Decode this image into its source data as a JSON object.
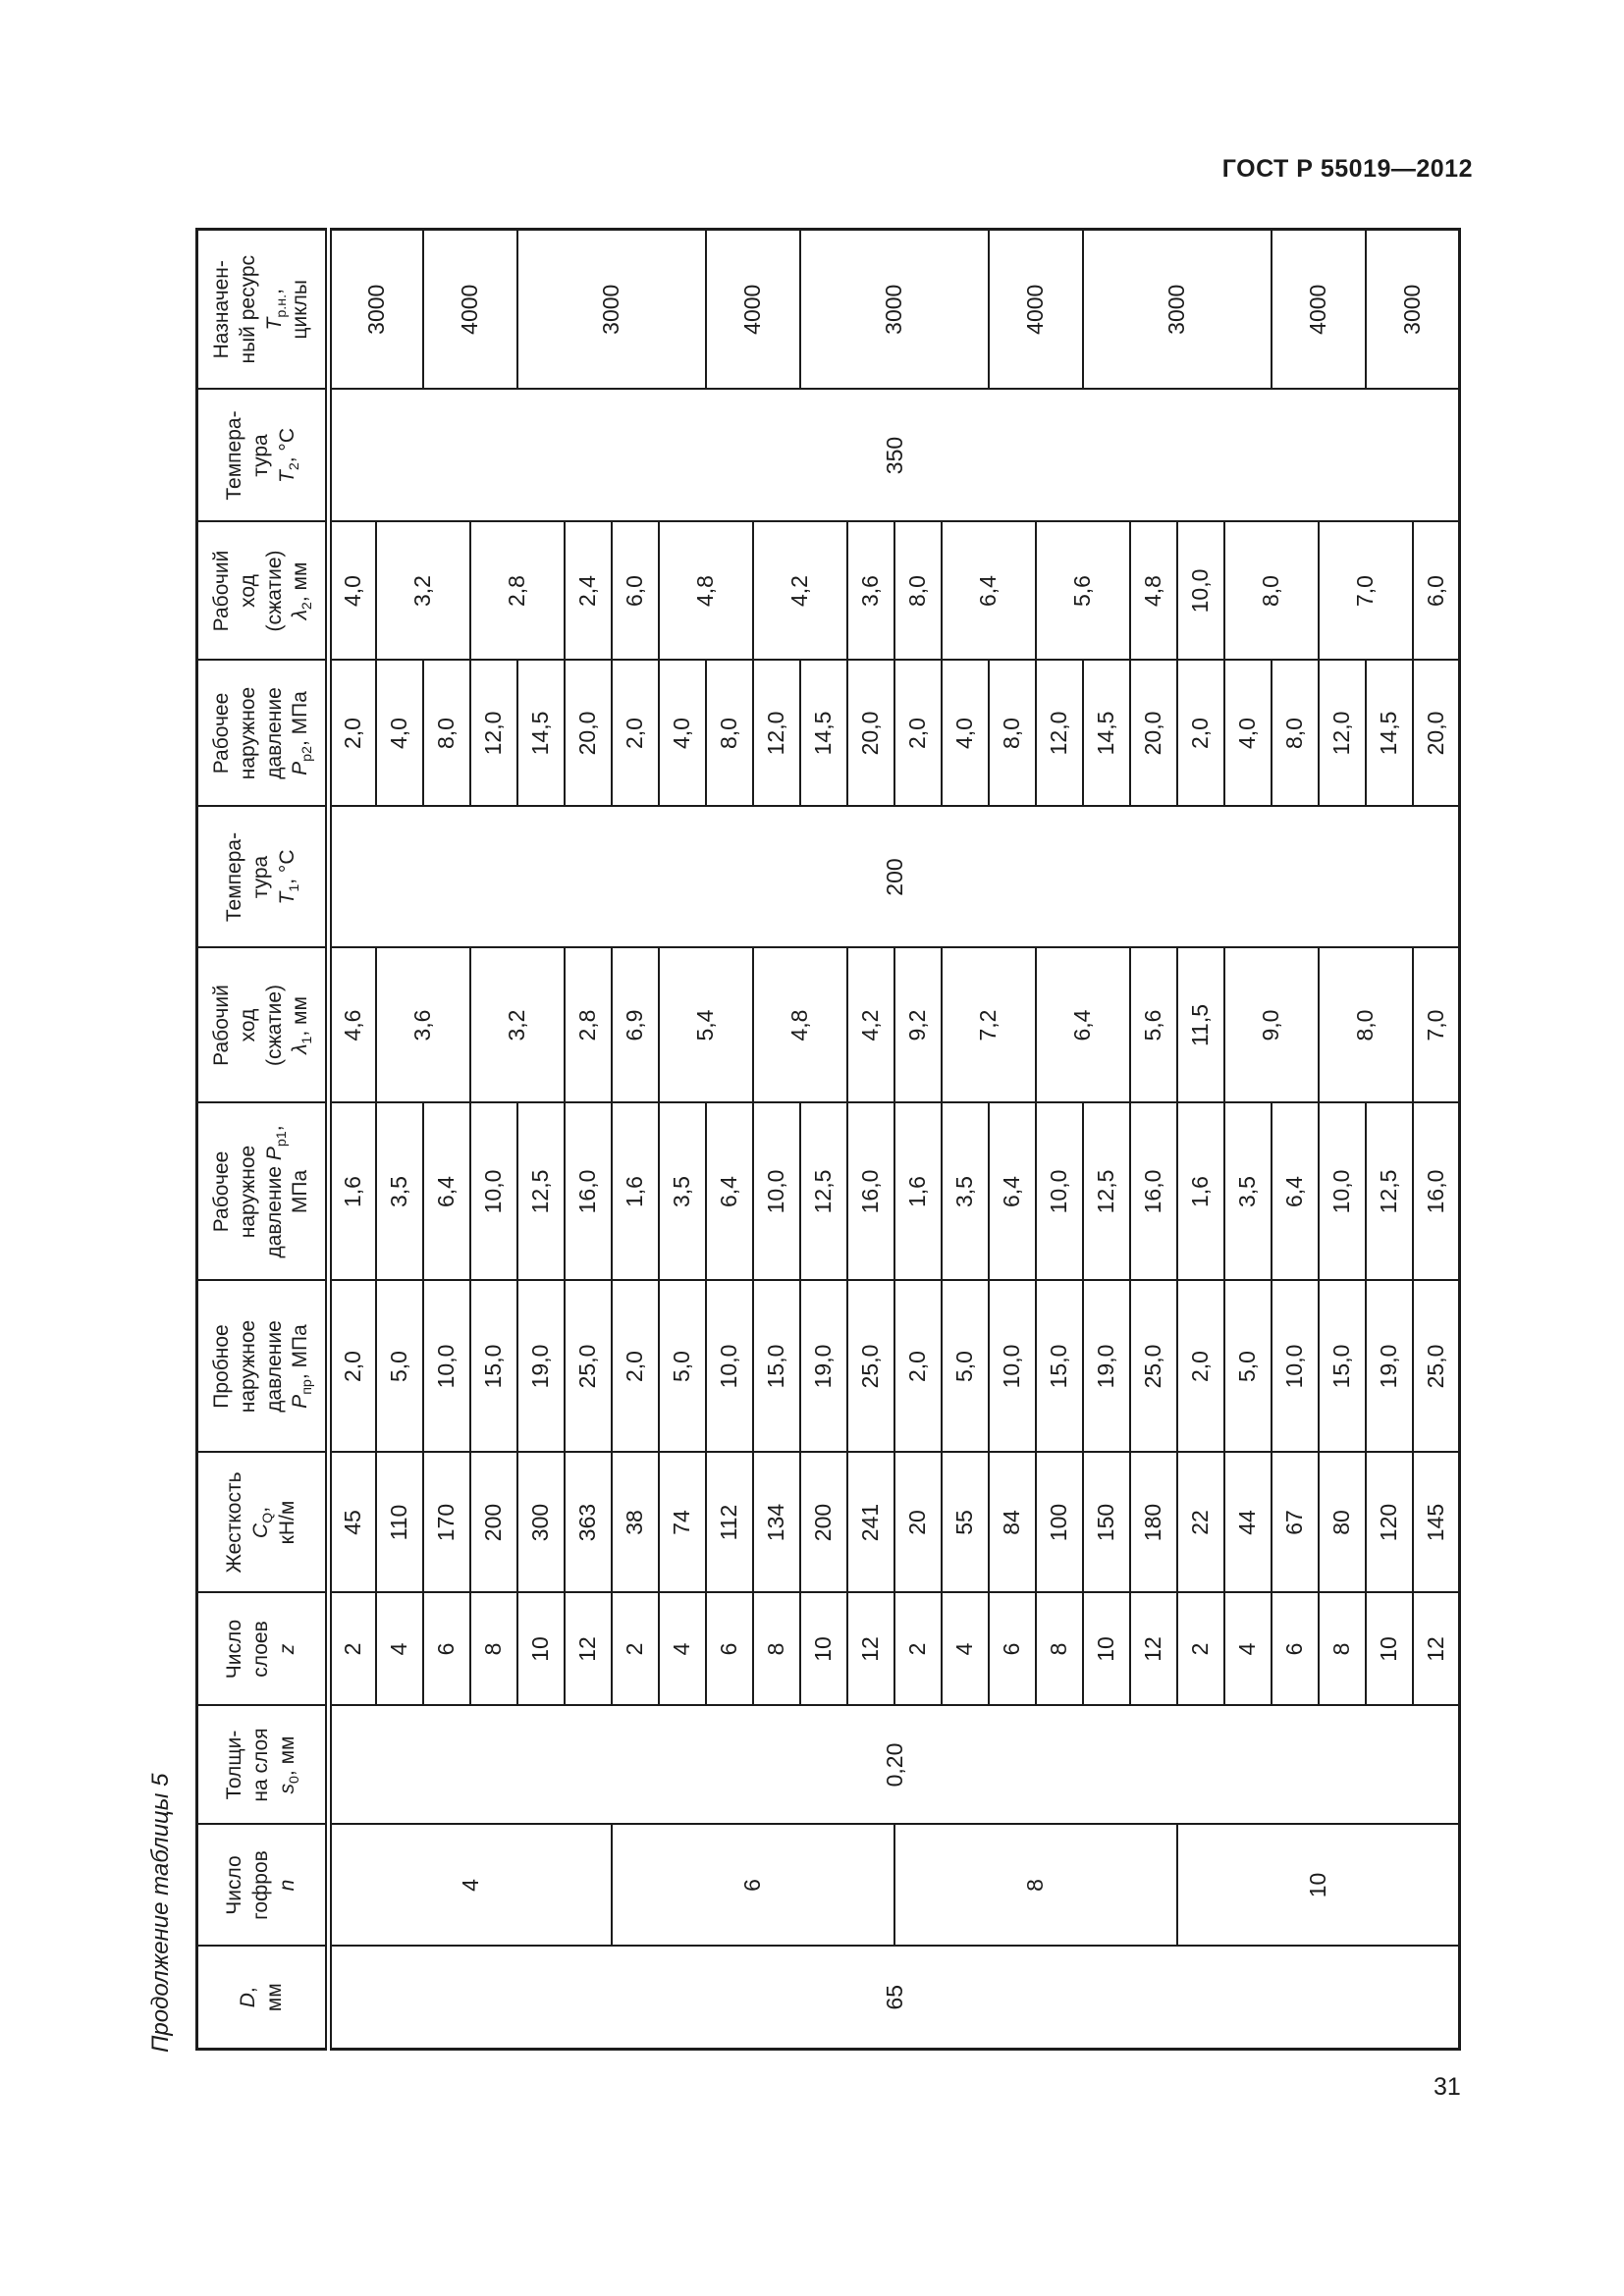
{
  "page": {
    "header_right": "ГОСТ Р 55019—2012",
    "page_number": "31",
    "caption": "Продолжение таблицы 5",
    "ink_color": "#1c1c1c",
    "paper_color": "#ffffff"
  },
  "table": {
    "row_count": 24,
    "columns": [
      {
        "key": "d",
        "header": "*D*,\nмм",
        "cells": [
          {
            "v": "65",
            "span": 24
          }
        ]
      },
      {
        "key": "n",
        "header": "Число\nгофров\n*n*",
        "cells": [
          {
            "v": "4",
            "span": 6
          },
          {
            "v": "6",
            "span": 6
          },
          {
            "v": "8",
            "span": 6
          },
          {
            "v": "10",
            "span": 6
          }
        ]
      },
      {
        "key": "s0",
        "header": "Толщи-\nна слоя\n*s*_0_, мм",
        "cells": [
          {
            "v": "0,20",
            "span": 24
          }
        ]
      },
      {
        "key": "z",
        "header": "Число\nслоев\n*z*",
        "cells": [
          {
            "v": "2",
            "span": 1
          },
          {
            "v": "4",
            "span": 1
          },
          {
            "v": "6",
            "span": 1
          },
          {
            "v": "8",
            "span": 1
          },
          {
            "v": "10",
            "span": 1
          },
          {
            "v": "12",
            "span": 1
          },
          {
            "v": "2",
            "span": 1
          },
          {
            "v": "4",
            "span": 1
          },
          {
            "v": "6",
            "span": 1
          },
          {
            "v": "8",
            "span": 1
          },
          {
            "v": "10",
            "span": 1
          },
          {
            "v": "12",
            "span": 1
          },
          {
            "v": "2",
            "span": 1
          },
          {
            "v": "4",
            "span": 1
          },
          {
            "v": "6",
            "span": 1
          },
          {
            "v": "8",
            "span": 1
          },
          {
            "v": "10",
            "span": 1
          },
          {
            "v": "12",
            "span": 1
          },
          {
            "v": "2",
            "span": 1
          },
          {
            "v": "4",
            "span": 1
          },
          {
            "v": "6",
            "span": 1
          },
          {
            "v": "8",
            "span": 1
          },
          {
            "v": "10",
            "span": 1
          },
          {
            "v": "12",
            "span": 1
          }
        ]
      },
      {
        "key": "cq",
        "header": "Жесткость\n*C*_Q_,\nкН/м",
        "cells": [
          {
            "v": "45",
            "span": 1
          },
          {
            "v": "110",
            "span": 1
          },
          {
            "v": "170",
            "span": 1
          },
          {
            "v": "200",
            "span": 1
          },
          {
            "v": "300",
            "span": 1
          },
          {
            "v": "363",
            "span": 1
          },
          {
            "v": "38",
            "span": 1
          },
          {
            "v": "74",
            "span": 1
          },
          {
            "v": "112",
            "span": 1
          },
          {
            "v": "134",
            "span": 1
          },
          {
            "v": "200",
            "span": 1
          },
          {
            "v": "241",
            "span": 1
          },
          {
            "v": "20",
            "span": 1
          },
          {
            "v": "55",
            "span": 1
          },
          {
            "v": "84",
            "span": 1
          },
          {
            "v": "100",
            "span": 1
          },
          {
            "v": "150",
            "span": 1
          },
          {
            "v": "180",
            "span": 1
          },
          {
            "v": "22",
            "span": 1
          },
          {
            "v": "44",
            "span": 1
          },
          {
            "v": "67",
            "span": 1
          },
          {
            "v": "80",
            "span": 1
          },
          {
            "v": "120",
            "span": 1
          },
          {
            "v": "145",
            "span": 1
          }
        ]
      },
      {
        "key": "ppr",
        "header": "Пробное\nнаружное\nдавление\n*P*_пр_, МПа",
        "cells": [
          {
            "v": "2,0",
            "span": 1
          },
          {
            "v": "5,0",
            "span": 1
          },
          {
            "v": "10,0",
            "span": 1
          },
          {
            "v": "15,0",
            "span": 1
          },
          {
            "v": "19,0",
            "span": 1
          },
          {
            "v": "25,0",
            "span": 1
          },
          {
            "v": "2,0",
            "span": 1
          },
          {
            "v": "5,0",
            "span": 1
          },
          {
            "v": "10,0",
            "span": 1
          },
          {
            "v": "15,0",
            "span": 1
          },
          {
            "v": "19,0",
            "span": 1
          },
          {
            "v": "25,0",
            "span": 1
          },
          {
            "v": "2,0",
            "span": 1
          },
          {
            "v": "5,0",
            "span": 1
          },
          {
            "v": "10,0",
            "span": 1
          },
          {
            "v": "15,0",
            "span": 1
          },
          {
            "v": "19,0",
            "span": 1
          },
          {
            "v": "25,0",
            "span": 1
          },
          {
            "v": "2,0",
            "span": 1
          },
          {
            "v": "5,0",
            "span": 1
          },
          {
            "v": "10,0",
            "span": 1
          },
          {
            "v": "15,0",
            "span": 1
          },
          {
            "v": "19,0",
            "span": 1
          },
          {
            "v": "25,0",
            "span": 1
          }
        ]
      },
      {
        "key": "pp1",
        "header": "Рабочее\nнаружное\nдавление *P*_р1_,\nМПа",
        "cells": [
          {
            "v": "1,6",
            "span": 1
          },
          {
            "v": "3,5",
            "span": 1
          },
          {
            "v": "6,4",
            "span": 1
          },
          {
            "v": "10,0",
            "span": 1
          },
          {
            "v": "12,5",
            "span": 1
          },
          {
            "v": "16,0",
            "span": 1
          },
          {
            "v": "1,6",
            "span": 1
          },
          {
            "v": "3,5",
            "span": 1
          },
          {
            "v": "6,4",
            "span": 1
          },
          {
            "v": "10,0",
            "span": 1
          },
          {
            "v": "12,5",
            "span": 1
          },
          {
            "v": "16,0",
            "span": 1
          },
          {
            "v": "1,6",
            "span": 1
          },
          {
            "v": "3,5",
            "span": 1
          },
          {
            "v": "6,4",
            "span": 1
          },
          {
            "v": "10,0",
            "span": 1
          },
          {
            "v": "12,5",
            "span": 1
          },
          {
            "v": "16,0",
            "span": 1
          },
          {
            "v": "1,6",
            "span": 1
          },
          {
            "v": "3,5",
            "span": 1
          },
          {
            "v": "6,4",
            "span": 1
          },
          {
            "v": "10,0",
            "span": 1
          },
          {
            "v": "12,5",
            "span": 1
          },
          {
            "v": "16,0",
            "span": 1
          }
        ]
      },
      {
        "key": "l1",
        "header": "Рабочий\nход\n(сжатие)\n*λ*_1_, мм",
        "cells": [
          {
            "v": "4,6",
            "span": 1
          },
          {
            "v": "3,6",
            "span": 2
          },
          {
            "v": "3,2",
            "span": 2
          },
          {
            "v": "2,8",
            "span": 1
          },
          {
            "v": "6,9",
            "span": 1
          },
          {
            "v": "5,4",
            "span": 2
          },
          {
            "v": "4,8",
            "span": 2
          },
          {
            "v": "4,2",
            "span": 1
          },
          {
            "v": "9,2",
            "span": 1
          },
          {
            "v": "7,2",
            "span": 2
          },
          {
            "v": "6,4",
            "span": 2
          },
          {
            "v": "5,6",
            "span": 1
          },
          {
            "v": "11,5",
            "span": 1
          },
          {
            "v": "9,0",
            "span": 2
          },
          {
            "v": "8,0",
            "span": 2
          },
          {
            "v": "7,0",
            "span": 1
          }
        ]
      },
      {
        "key": "t1",
        "header": "Темпера-\nтура\n*T*_1_, °C",
        "cells": [
          {
            "v": "200",
            "span": 24
          }
        ]
      },
      {
        "key": "pp2",
        "header": "Рабочее\nнаружное\nдавление\n*P*_р2_, МПа",
        "cells": [
          {
            "v": "2,0",
            "span": 1
          },
          {
            "v": "4,0",
            "span": 1
          },
          {
            "v": "8,0",
            "span": 1
          },
          {
            "v": "12,0",
            "span": 1
          },
          {
            "v": "14,5",
            "span": 1
          },
          {
            "v": "20,0",
            "span": 1
          },
          {
            "v": "2,0",
            "span": 1
          },
          {
            "v": "4,0",
            "span": 1
          },
          {
            "v": "8,0",
            "span": 1
          },
          {
            "v": "12,0",
            "span": 1
          },
          {
            "v": "14,5",
            "span": 1
          },
          {
            "v": "20,0",
            "span": 1
          },
          {
            "v": "2,0",
            "span": 1
          },
          {
            "v": "4,0",
            "span": 1
          },
          {
            "v": "8,0",
            "span": 1
          },
          {
            "v": "12,0",
            "span": 1
          },
          {
            "v": "14,5",
            "span": 1
          },
          {
            "v": "20,0",
            "span": 1
          },
          {
            "v": "2,0",
            "span": 1
          },
          {
            "v": "4,0",
            "span": 1
          },
          {
            "v": "8,0",
            "span": 1
          },
          {
            "v": "12,0",
            "span": 1
          },
          {
            "v": "14,5",
            "span": 1
          },
          {
            "v": "20,0",
            "span": 1
          }
        ]
      },
      {
        "key": "l2",
        "header": "Рабочий\nход\n(сжатие)\n*λ*_2_, мм",
        "cells": [
          {
            "v": "4,0",
            "span": 1
          },
          {
            "v": "3,2",
            "span": 2
          },
          {
            "v": "2,8",
            "span": 2
          },
          {
            "v": "2,4",
            "span": 1
          },
          {
            "v": "6,0",
            "span": 1
          },
          {
            "v": "4,8",
            "span": 2
          },
          {
            "v": "4,2",
            "span": 2
          },
          {
            "v": "3,6",
            "span": 1
          },
          {
            "v": "8,0",
            "span": 1
          },
          {
            "v": "6,4",
            "span": 2
          },
          {
            "v": "5,6",
            "span": 2
          },
          {
            "v": "4,8",
            "span": 1
          },
          {
            "v": "10,0",
            "span": 1
          },
          {
            "v": "8,0",
            "span": 2
          },
          {
            "v": "7,0",
            "span": 2
          },
          {
            "v": "6,0",
            "span": 1
          }
        ]
      },
      {
        "key": "t2",
        "header": "Темпера-\nтура\n*T*_2_, °C",
        "cells": [
          {
            "v": "350",
            "span": 24
          }
        ]
      },
      {
        "key": "res",
        "header": "Назначен-\nный ресурс\n*T*_р.н._,\nциклы",
        "cells": [
          {
            "v": "3000",
            "span": 2
          },
          {
            "v": "4000",
            "span": 2
          },
          {
            "v": "3000",
            "span": 4
          },
          {
            "v": "4000",
            "span": 2
          },
          {
            "v": "3000",
            "span": 4
          },
          {
            "v": "4000",
            "span": 2
          },
          {
            "v": "3000",
            "span": 4
          },
          {
            "v": "4000",
            "span": 2
          },
          {
            "v": "3000",
            "span": 2
          }
        ]
      }
    ]
  }
}
